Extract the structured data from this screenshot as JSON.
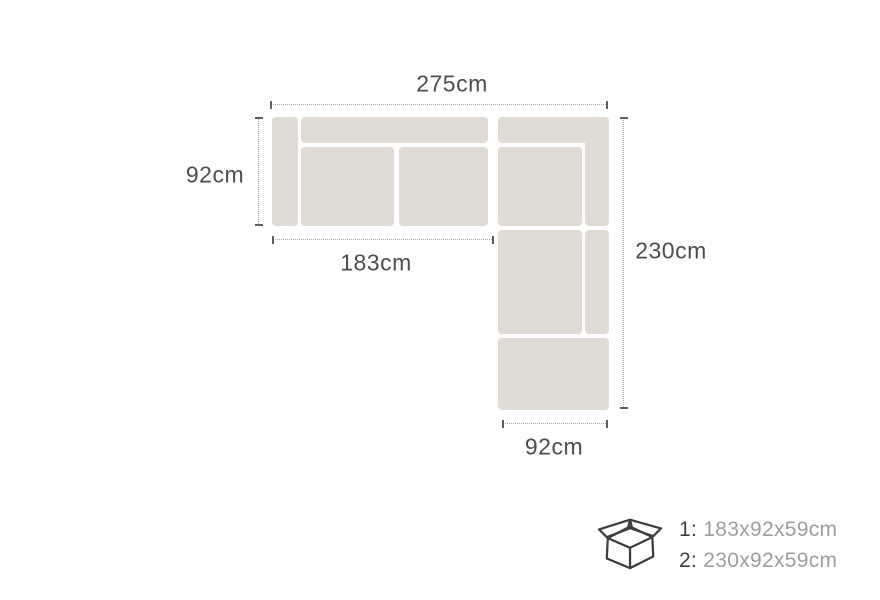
{
  "diagram": {
    "dimension_labels": {
      "top_width": "275cm",
      "left_depth": "92cm",
      "chaise_length": "183cm",
      "right_length": "230cm",
      "bottom_width": "92cm"
    },
    "colors": {
      "sofa_fill": "#e0dbd5",
      "dim_line": "#a8a8a8",
      "dim_tick": "#5f5f5f",
      "label_text": "#4d4d4d"
    }
  },
  "packaging": {
    "icon": "open-box-icon",
    "items": [
      {
        "label": "1:",
        "size": "183x92x59cm"
      },
      {
        "label": "2:",
        "size": "230x92x59cm"
      }
    ],
    "colors": {
      "label": "#3d3d3d",
      "size": "#9e9e9e"
    }
  }
}
